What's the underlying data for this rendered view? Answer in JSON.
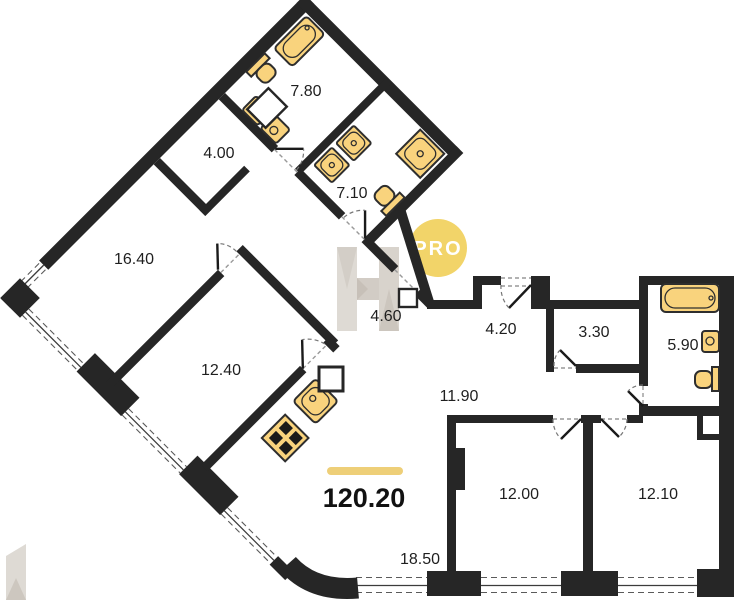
{
  "floorplan": {
    "badge": "PRO",
    "total": {
      "area": "120.20"
    },
    "rooms": [
      {
        "name": "bathroom-top",
        "area": "7.80"
      },
      {
        "name": "wardrobe",
        "area": "4.00"
      },
      {
        "name": "bedroom-large",
        "area": "16.40"
      },
      {
        "name": "bathroom-mid",
        "area": "7.10"
      },
      {
        "name": "hall-wing",
        "area": "4.60"
      },
      {
        "name": "bedroom-mid",
        "area": "12.40"
      },
      {
        "name": "entry-hall",
        "area": "4.20"
      },
      {
        "name": "storage",
        "area": "3.30"
      },
      {
        "name": "bathroom-right",
        "area": "5.90"
      },
      {
        "name": "corridor",
        "area": "11.90"
      },
      {
        "name": "bedroom-bottom-left",
        "area": "12.00"
      },
      {
        "name": "bedroom-bottom-right",
        "area": "12.10"
      },
      {
        "name": "living-kitchen",
        "area": "18.50"
      }
    ],
    "colors": {
      "wall": "#262626",
      "fixture": "#F9D37D",
      "accent_bar": "#EECF78",
      "badge_bg": "#F2D469",
      "badge_text": "#FFFFFF",
      "label": "#1F1F1F",
      "watermark": "#D9D4CD"
    }
  }
}
